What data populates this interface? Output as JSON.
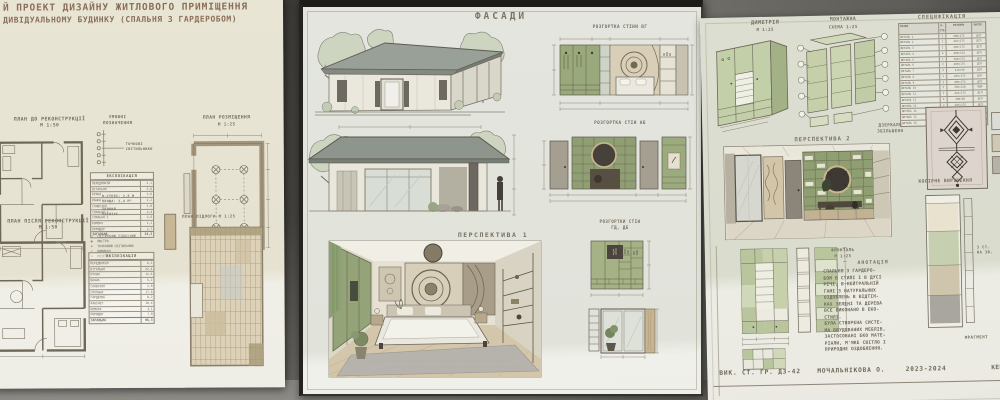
{
  "palette": {
    "paper_left": "#e9e5d5",
    "paper_mid": "#e3e5de",
    "paper_right": "#dcded1",
    "ink": "#756d5e",
    "green": "#93a376",
    "floor": "#57554f"
  },
  "board_left": {
    "title1": "Й ПРОЕКТ ДИЗАЙНУ ЖИТЛОВОГО ПРИМІЩЕННЯ",
    "title2": "ДИВІДУАЛЬНОМУ БУДИНКУ (СПАЛЬНЯ З ГАРДЕРОБОМ)",
    "plan_before": "ПЛАН ДО РЕКОНСТРУКЦІЇ",
    "plan_before_scale": "М 1:50",
    "legend_title1": "УМОВНІ",
    "legend_title2": "ПОЗНАЧЕННЯ",
    "legend_note1": "ТОЧКОВІ",
    "legend_note2": "СВІТИЛЬНИКИ",
    "expl1": {
      "title": "ЕКСПЛІКАЦІЯ",
      "total_label": "ЗАГАЛЬНА",
      "total": "26,3",
      "rows": [
        {
          "name": "ПЕРЕДПОКІЙ",
          "area": "2,1"
        },
        {
          "name": "ВІТАЛЬНЯ",
          "area": "5,8"
        },
        {
          "name": "КУХНЯ",
          "area": "3,6"
        },
        {
          "name": "ВАННА",
          "area": "2,2"
        },
        {
          "name": "САНВУЗОЛ",
          "area": "1,8"
        },
        {
          "name": "СПАЛЬНЯ 1",
          "area": "4,4"
        },
        {
          "name": "СПАЛЬНЯ 2",
          "area": "2,6"
        },
        {
          "name": "КОМОРА",
          "area": "1,1"
        },
        {
          "name": "КОРИДОР",
          "area": "2,7"
        }
      ]
    },
    "legend_items": [
      {
        "sym": "◯",
        "label": "СВІТИЛЬНИК ПІДВІСНИЙ"
      },
      {
        "sym": "◉",
        "label": "ЛЮСТРА"
      },
      {
        "sym": "⊙",
        "label": "ТОЧКОВИЙ СВІТИЛЬНИК"
      },
      {
        "sym": "⌐",
        "label": "ВИМИКАЧ"
      },
      {
        "sym": "∿",
        "label": "РОЗЕТКА"
      }
    ],
    "lights_plan": "ПЛАН РОЗМІЩЕННЯ",
    "lights_plan_scale": "М 1:25",
    "note_line1": "Н-СТЕЛІ: 2,5 М",
    "note_line2": "ПЛОЩА: 2,4 М²",
    "warm_line1": "ТЕПЛИЙ",
    "warm_line2": "ПЛІНТУС",
    "plan_after": "ПЛАН ПІСЛЯ РЕКОНСТРУКЦІЇ",
    "plan_after_scale": "М 1:50",
    "expl2": {
      "title": "ЕКСПЛІКАЦІЯ",
      "total_label": "ЗАГАЛЬНА",
      "total": "96,3",
      "rows": [
        {
          "name": "ПЕРЕДПОКІЙ",
          "area": "6,2"
        },
        {
          "name": "ВІТАЛЬНЯ",
          "area": "22,4"
        },
        {
          "name": "КУХНЯ",
          "area": "12,6"
        },
        {
          "name": "ВАННА",
          "area": "5,2"
        },
        {
          "name": "САНВУЗОЛ",
          "area": "2,8"
        },
        {
          "name": "СПАЛЬНЯ",
          "area": "17,6"
        },
        {
          "name": "ГАРДЕРОБ",
          "area": "8,2"
        },
        {
          "name": "КАБІНЕТ",
          "area": "10,4"
        },
        {
          "name": "КОМОРА",
          "area": "3,1"
        },
        {
          "name": "КОРИДОР",
          "area": "7,8"
        }
      ]
    },
    "floor_plan_label": "ПЛАН ПІДЛОГИ  М 1:25"
  },
  "board_middle": {
    "facades_title": "ФАСАДИ",
    "perspective1_label": "ПЕРСПЕКТИВА 1",
    "elevation1_label": "РОЗГОРТКА СТІНИ ВГ",
    "elevation2_label": "РОЗГОРТКА СТІН АБ",
    "elevation3_label1": "РОЗГОРТКИ СТІН",
    "elevation3_label2": "ГД,  ДЕ"
  },
  "board_right": {
    "dimetry_label": "ДИМЕТРІЯ",
    "dimetry_scale": "М 1:25",
    "montage_label1": "МОНТАЖНА",
    "montage_label2": "СХЕМА 1:25",
    "spec": {
      "title": "СПЕЦИФІКАЦІЯ",
      "header": {
        "name": "НАЗВА",
        "qty": "К-СТЬ",
        "size": "РОЗМІРИ",
        "mat": "МАТЕР."
      },
      "rows": [
        {
          "name": "ДЕТАЛЬ 1",
          "qty": "2",
          "size": "400×175",
          "mat": "ДСП"
        },
        {
          "name": "ДЕТАЛЬ 2",
          "qty": "1",
          "size": "416×175",
          "mat": "ДСП"
        },
        {
          "name": "ДЕТАЛЬ 3",
          "qty": "2",
          "size": "205×175",
          "mat": "ДСП"
        },
        {
          "name": "ДЕТАЛЬ 4",
          "qty": "4",
          "size": "400×120",
          "mat": "ДСП"
        },
        {
          "name": "ДЕТАЛЬ 5",
          "qty": "1",
          "size": "380×175",
          "mat": "ДСП"
        },
        {
          "name": "ДЕТАЛЬ 6",
          "qty": "2",
          "size": "400×175",
          "mat": "ДСП"
        },
        {
          "name": "ДЕТАЛЬ 7",
          "qty": "3",
          "size": "416×90",
          "mat": "ДСП"
        },
        {
          "name": "ДЕТАЛЬ 8",
          "qty": "1",
          "size": "205×175",
          "mat": "ДСП"
        },
        {
          "name": "ДЕТАЛЬ 9",
          "qty": "2",
          "size": "400×175",
          "mat": "ДСП"
        },
        {
          "name": "ДЕТАЛЬ 10",
          "qty": "2",
          "size": "350×120",
          "mat": "МДФ"
        },
        {
          "name": "ДЕТАЛЬ 11",
          "qty": "1",
          "size": "416×175",
          "mat": "ДСП"
        },
        {
          "name": "ДЕТАЛЬ 12",
          "qty": "4",
          "size": "400×90",
          "mat": "ДСП"
        },
        {
          "name": "ДЕТАЛЬ 13",
          "qty": "2",
          "size": "205×175",
          "mat": "ДСП"
        },
        {
          "name": "ДЕТАЛЬ 14",
          "qty": "1",
          "size": "380×175",
          "mat": "МДФ"
        },
        {
          "name": "ДЕТАЛЬ 15",
          "qty": "2",
          "size": "400×175",
          "mat": "ДСП"
        },
        {
          "name": "ДЕТАЛЬ 16",
          "qty": "3",
          "size": "416×175",
          "mat": "ДСП"
        }
      ]
    },
    "mirror_label1": "ДЗЕРКАЛО",
    "mirror_label2": "ЗБІЛЬШЕНО",
    "perspective2_label": "ПЕРСПЕКТИВА 2",
    "color_label": "КОЛІРНЕ ВИРІШЕННЯ",
    "frontal_label1": "ФРОНТАЛЬ",
    "frontal_label2": "М 1:25",
    "annotation_title": "АНОТАЦІЯ",
    "annotation_lines": [
      "СПАЛЬНЯ З ГАРДЕРО-",
      "БОМ В СТИЛІ І В ДУСІ",
      "РЕЧІ, В НЕЙТРАЛЬНІЙ",
      "ГАМІ З НАТУРАЛЬНИХ",
      "ОЗДОБЛЕНЬ В ВІДТІН-",
      "КАХ ЗЕЛЕНІ ТА ДЕРЕВА",
      "ВСЕ ВИКОНАНО В ЕКО-",
      "СТИЛІ.",
      "БУЛА СТВОРЕНА СИСТЕ-",
      "МА ВБУДОВАНИХ МЕБЛІВ,",
      "ЗАСТОСОВАНІ ЕКО МАТЕ-",
      "РІАЛИ, М'ЯКЕ СВІТЛО І",
      "ПРИРОДНЕ ОЗДОБЛЕННЯ."
    ],
    "corner_note1": "З СТ.",
    "corner_note2": "НА ЗВ.",
    "fragment_label": "ФРАГМЕНТ",
    "footer_group": "ВИК. СТ. ГР. ДЗ-42",
    "footer_name": "МОЧАЛЬНІКОВА О.",
    "footer_years": "2023-2024",
    "footer_right": "КЕРІВ"
  }
}
